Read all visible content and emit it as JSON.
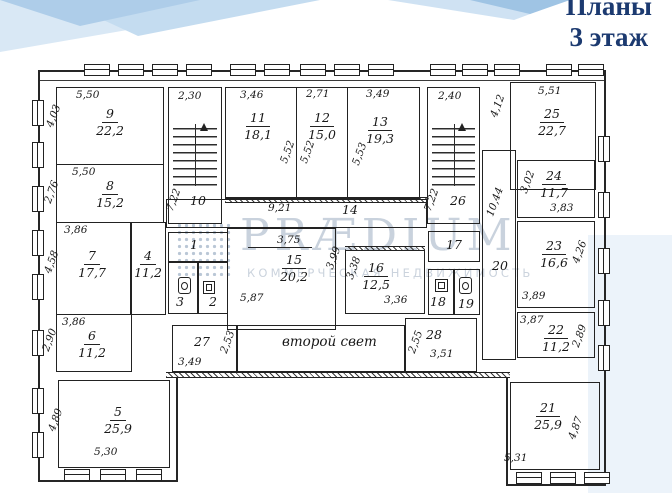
{
  "header": {
    "line1": "Планы",
    "line2": "3 этаж"
  },
  "watermark": {
    "brand": "PRÆDIUM",
    "tagline": "КОММЕРЧЕСКАЯ НЕДВИЖИМОСТЬ"
  },
  "labels": {
    "second_light": "второй свет"
  },
  "colors": {
    "title_blue": "#1c3a70",
    "watermark_gray": "#c0cbd8",
    "ink": "#222222",
    "decor_blue": "#aecde9"
  },
  "rooms": {
    "r1": {
      "num": "1"
    },
    "r2": {
      "num": "2"
    },
    "r3": {
      "num": "3"
    },
    "r4": {
      "num": "4",
      "area": "11,2"
    },
    "r5": {
      "num": "5",
      "area": "25,9",
      "w": "5,30",
      "h": "4,89"
    },
    "r6": {
      "num": "6",
      "area": "11,2",
      "w": "3,86",
      "h": "2,90"
    },
    "r7": {
      "num": "7",
      "area": "17,7",
      "w": "3,86",
      "h": "4,58"
    },
    "r8": {
      "num": "8",
      "area": "15,2",
      "w": "5,50",
      "h": "2,76"
    },
    "r9": {
      "num": "9",
      "area": "22,2",
      "w": "5,50",
      "h": "4,03"
    },
    "r10": {
      "num": "10",
      "w": "2,30",
      "h": "7,22"
    },
    "r11": {
      "num": "11",
      "area": "18,1",
      "w": "3,46",
      "h": "5,52"
    },
    "r12": {
      "num": "12",
      "area": "15,0",
      "w": "2,71",
      "h": "5,52"
    },
    "r13": {
      "num": "13",
      "area": "19,3",
      "w": "3,49",
      "h": "5,53"
    },
    "r14": {
      "num": "14",
      "w": "9,21"
    },
    "r15": {
      "num": "15",
      "area": "20,2",
      "w": "5,87",
      "h": "3,99",
      "d": "3,75"
    },
    "r16": {
      "num": "16",
      "area": "12,5",
      "w": "3,36",
      "h": "3,38"
    },
    "r17": {
      "num": "17"
    },
    "r18": {
      "num": "18"
    },
    "r19": {
      "num": "19"
    },
    "r20": {
      "num": "20",
      "h": "10,44"
    },
    "r21": {
      "num": "21",
      "area": "25,9",
      "w": "5,31",
      "h": "4,87"
    },
    "r22": {
      "num": "22",
      "area": "11,2",
      "w": "3,87",
      "h": "2,89"
    },
    "r23": {
      "num": "23",
      "area": "16,6",
      "w": "3,89",
      "h": "4,26"
    },
    "r24": {
      "num": "24",
      "area": "11,7",
      "w": "3,83",
      "h": "3,02"
    },
    "r25": {
      "num": "25",
      "area": "22,7",
      "w": "5,51",
      "h": "4,12"
    },
    "r26": {
      "num": "26",
      "w": "2,40",
      "h": "7,22"
    },
    "r27": {
      "num": "27",
      "w": "3,49",
      "h": "2,53"
    },
    "r28": {
      "num": "28",
      "w": "3,51",
      "h": "2,55"
    }
  }
}
